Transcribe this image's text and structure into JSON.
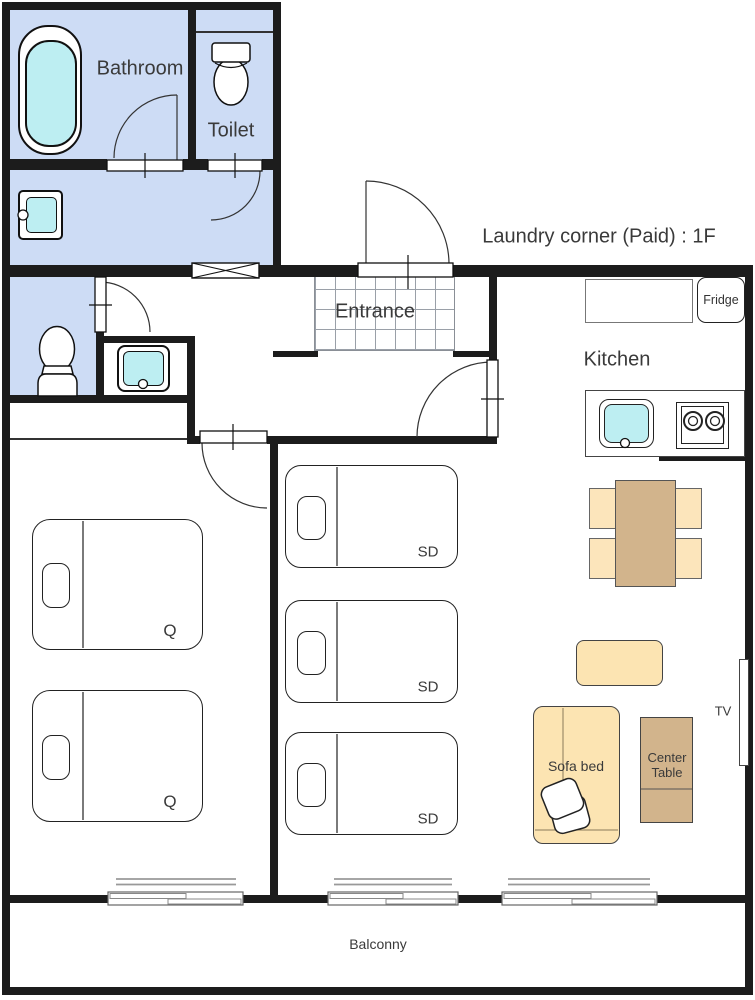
{
  "title": "Apartment floor plan",
  "labels": {
    "bathroom": "Bathroom",
    "toilet": "Toilet",
    "laundry": "Laundry corner (Paid) : 1F",
    "entrance": "Entrance",
    "kitchen": "Kitchen",
    "fridge": "Fridge",
    "sofa_bed": "Sofa bed",
    "center_table": "Center Table",
    "tv": "TV",
    "balcony": "Balconny"
  },
  "beds": {
    "queen": [
      {
        "label": "Q"
      },
      {
        "label": "Q"
      }
    ],
    "single": [
      {
        "label": "SD"
      },
      {
        "label": "SD"
      },
      {
        "label": "SD"
      }
    ]
  },
  "colors": {
    "wall": "#1c1c1c",
    "wet_room": "#cddcf5",
    "water": "#bdeef2",
    "wood_dark": "#d2b48c",
    "wood_light": "#fce5bb",
    "sofa": "#fce4b2"
  }
}
